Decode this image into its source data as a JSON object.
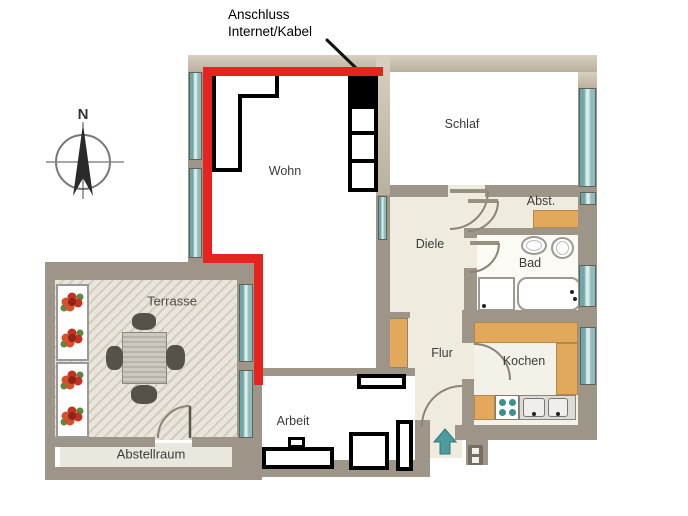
{
  "annotation": {
    "line1": "Anschluss",
    "line2": "Internet/Kabel"
  },
  "compass": {
    "north_label": "N"
  },
  "rooms": {
    "wohn": {
      "label": "Wohn"
    },
    "schlaf": {
      "label": "Schlaf"
    },
    "diele": {
      "label": "Diele"
    },
    "abst": {
      "label": "Abst."
    },
    "bad": {
      "label": "Bad"
    },
    "flur": {
      "label": "Flur"
    },
    "kochen": {
      "label": "Kochen"
    },
    "arbeit": {
      "label": "Arbeit"
    },
    "terrasse": {
      "label": "Terrasse"
    },
    "abstellraum": {
      "label": "Abstellraum"
    }
  },
  "colors": {
    "wall_gray": "#9d9588",
    "wall_tan": "#cdc4b2",
    "floor_cream": "#efebde",
    "room_white": "#ffffff",
    "terrace_floor": "#e7e3d8",
    "counter_tan": "#e2a95c",
    "window_teal": "#7fb2b2",
    "highlight_red": "#e6231d",
    "entry_arrow_teal": "#4d9ba0",
    "furniture_outline": "#000000"
  }
}
